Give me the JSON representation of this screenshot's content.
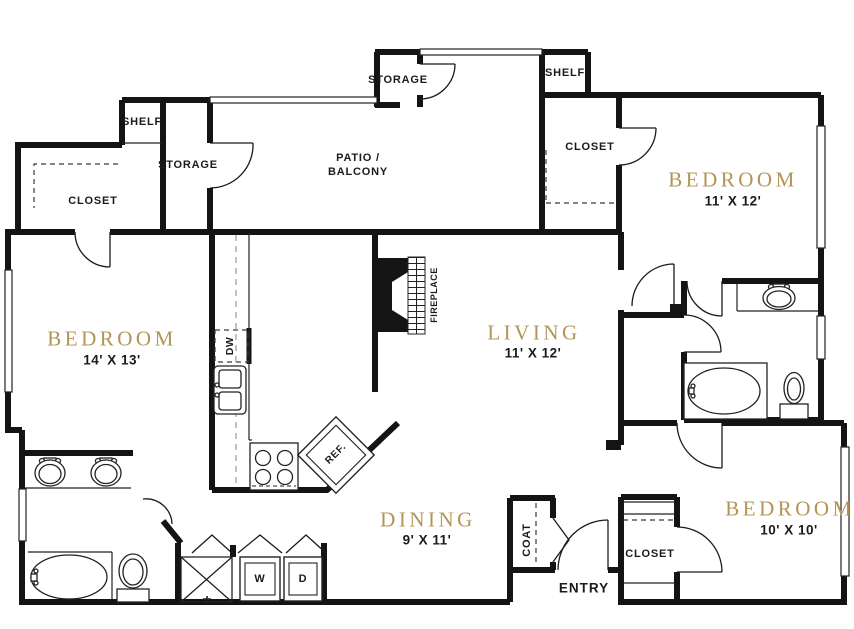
{
  "plan": {
    "rooms": [
      {
        "name": "BEDROOM",
        "dims": "14' X 13'"
      },
      {
        "name": "LIVING",
        "dims": "11' X 12'"
      },
      {
        "name": "DINING",
        "dims": "9' X 11'"
      },
      {
        "name": "BEDROOM",
        "dims": "11' X 12'"
      },
      {
        "name": "BEDROOM",
        "dims": "10' X 10'"
      }
    ],
    "areas": {
      "patio_line1": "PATIO /",
      "patio_line2": "BALCONY",
      "entry": "ENTRY"
    },
    "closets": {
      "shelf_left": "SHELF",
      "closet_left": "CLOSET",
      "storage_left": "STORAGE",
      "storage_patio": "STORAGE",
      "shelf_right": "SHELF",
      "closet_right": "CLOSET",
      "closet_bottom": "CLOSET",
      "coat": "COAT"
    },
    "fixtures": {
      "dw": "DW",
      "ref": "REF.",
      "fireplace": "FIREPLACE",
      "washer": "W",
      "dryer": "D"
    },
    "colors": {
      "room_label": "#b39456",
      "wall": "#141414",
      "text": "#1b1b1b"
    }
  }
}
